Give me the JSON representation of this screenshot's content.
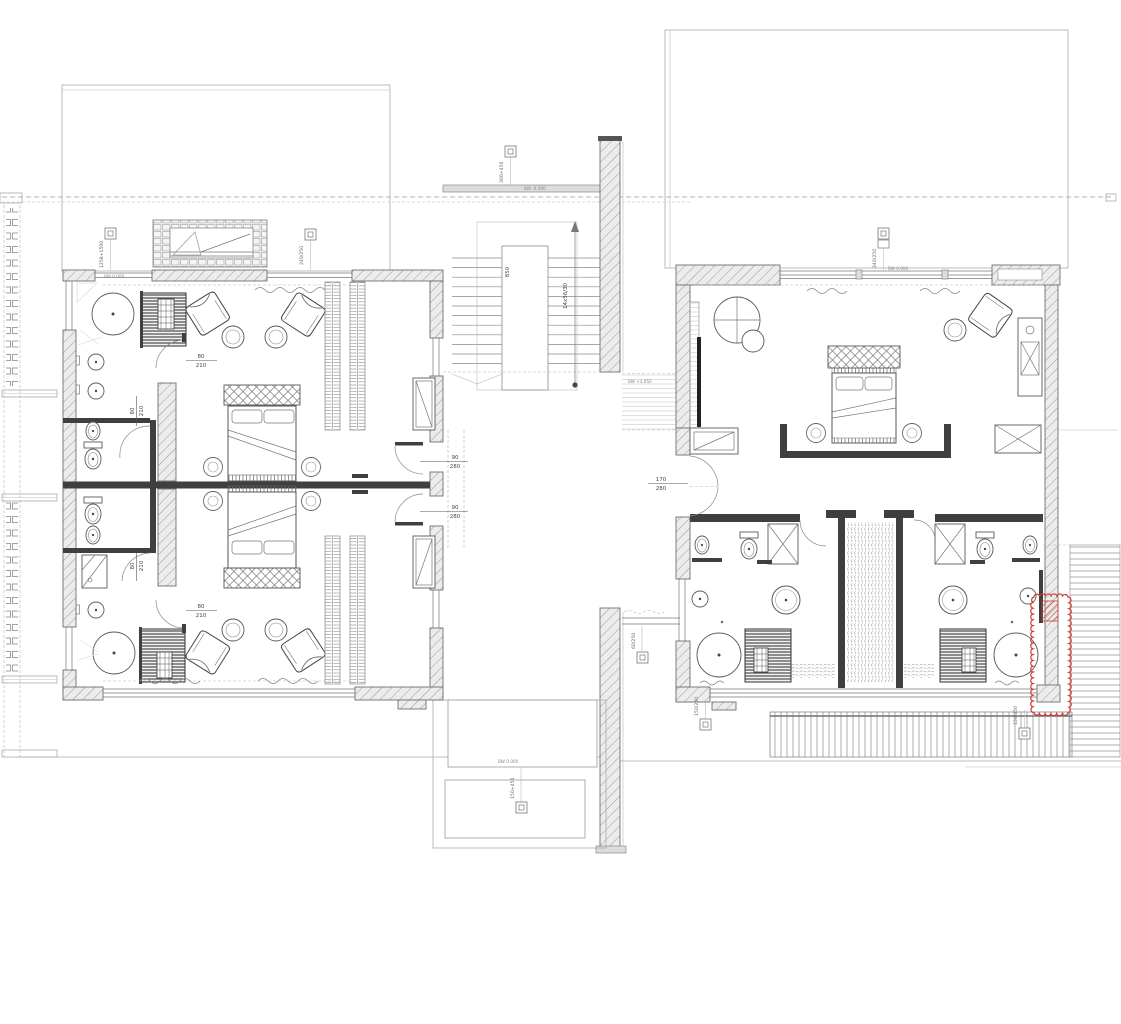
{
  "drawing": {
    "type": "architectural-floor-plan",
    "description": "Upper floor plan: two bedroom wings with bathrooms, saunas and round tubs, linked by a central stair; terraces, louvered deck, red revision cloud on right wing"
  },
  "door_tags": {
    "d80": {
      "w": "80",
      "h": "210"
    },
    "d90": {
      "w": "90",
      "h": "280"
    },
    "d170": {
      "w": "170",
      "h": "280"
    }
  },
  "window_tags": {
    "left": "1258+1500",
    "left_mid": "240/250",
    "stair": "300+450",
    "right": "240/250",
    "bridge": "60/250",
    "pool": "150+450",
    "deck_left": "150/250",
    "deck_right": "150/250"
  },
  "levels": {
    "bedroom_left": "BW 0.000",
    "bedroom_right": "BW 0.000",
    "stair_top": "BW -0.500",
    "bridge": "BW +3.050",
    "pool": "BW 0.000"
  },
  "stair": {
    "run": "14x56/30",
    "width": "850"
  },
  "colors": {
    "wall_hatch": "#9a9a9a",
    "partition_dark": "#3f3f3f",
    "line": "#6f6f6f",
    "site": "#aaaaaa",
    "revision_red": "#cc3b36"
  }
}
